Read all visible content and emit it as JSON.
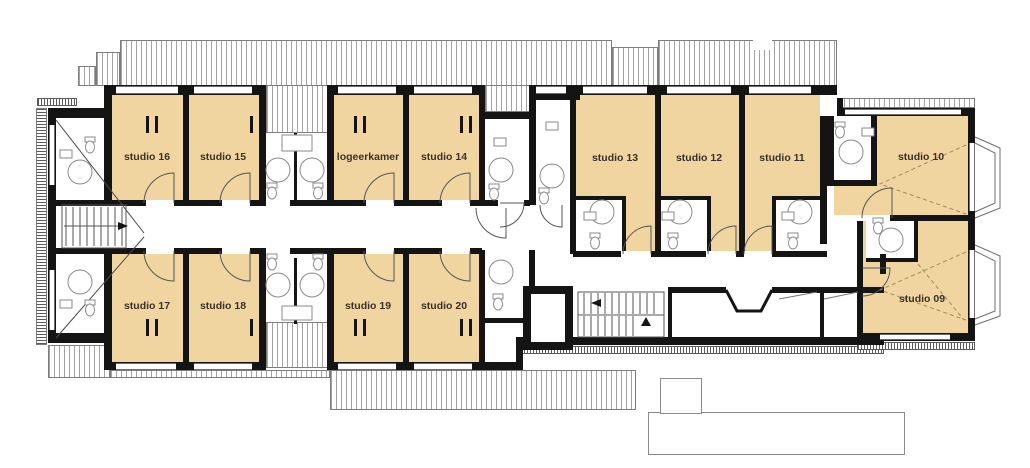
{
  "plan": {
    "rooms": [
      {
        "id": "studio-16",
        "label": "studio 16"
      },
      {
        "id": "studio-15",
        "label": "studio 15"
      },
      {
        "id": "logeerkamer",
        "label": "logeerkamer"
      },
      {
        "id": "studio-14",
        "label": "studio 14"
      },
      {
        "id": "studio-13",
        "label": "studio 13"
      },
      {
        "id": "studio-12",
        "label": "studio 12"
      },
      {
        "id": "studio-11",
        "label": "studio 11"
      },
      {
        "id": "studio-10",
        "label": "studio 10"
      },
      {
        "id": "studio-17",
        "label": "studio 17"
      },
      {
        "id": "studio-18",
        "label": "studio 18"
      },
      {
        "id": "studio-19",
        "label": "studio 19"
      },
      {
        "id": "studio-20",
        "label": "studio 20"
      },
      {
        "id": "studio-09",
        "label": "studio 09"
      }
    ],
    "colors": {
      "room_fill": "#F1D5A1",
      "wall": "#141414",
      "hatch_line": "#a3a3a3",
      "fixture_line": "#8a8a8a",
      "label_text": "#39322a"
    }
  }
}
